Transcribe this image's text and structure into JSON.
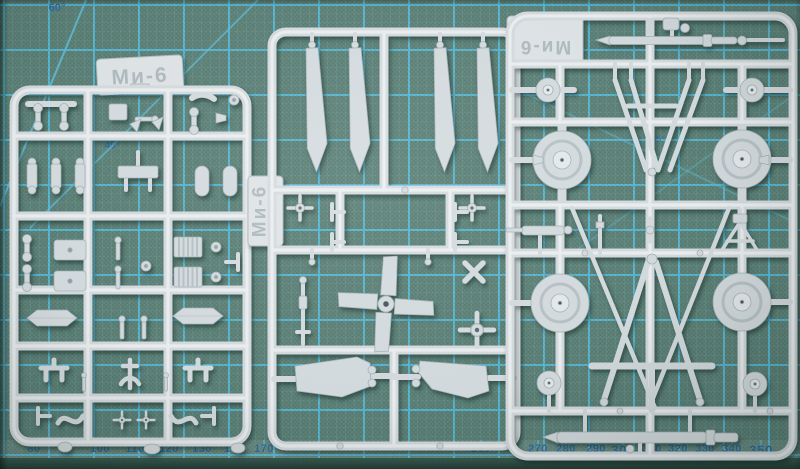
{
  "mat": {
    "angle_labels": [
      {
        "text": "60°",
        "x": 57,
        "y": 8,
        "size": 11,
        "opacity": 1
      },
      {
        "text": "45°",
        "x": 112,
        "y": 146,
        "size": 10,
        "opacity": 1
      },
      {
        "text": "45°",
        "x": 658,
        "y": 139,
        "size": 9,
        "opacity": 0.65
      }
    ],
    "ruler_labels": [
      {
        "text": "80",
        "x": 34,
        "large": false
      },
      {
        "text": "100",
        "x": 100,
        "large": false
      },
      {
        "text": "110",
        "x": 135,
        "large": false
      },
      {
        "text": "120",
        "x": 169,
        "large": false
      },
      {
        "text": "130",
        "x": 202,
        "large": false
      },
      {
        "text": "140",
        "x": 234,
        "large": false
      },
      {
        "text": "170",
        "x": 264,
        "large": false
      },
      {
        "text": "260",
        "x": 481,
        "large": false
      },
      {
        "text": "270",
        "x": 538,
        "large": false
      },
      {
        "text": "280",
        "x": 566,
        "large": false
      },
      {
        "text": "290",
        "x": 596,
        "large": false
      },
      {
        "text": "300",
        "x": 623,
        "large": true
      },
      {
        "text": "310",
        "x": 652,
        "large": false
      },
      {
        "text": "320",
        "x": 678,
        "large": false
      },
      {
        "text": "330",
        "x": 705,
        "large": false
      },
      {
        "text": "340",
        "x": 732,
        "large": false
      },
      {
        "text": "350",
        "x": 761,
        "large": true
      }
    ],
    "colors": {
      "mat_base": "#5d8278",
      "grid_major": "#54b6d3",
      "ruler_text": "#2e6d9c",
      "mat_edge": "#2d4c44"
    }
  },
  "sprues": {
    "plastic_color": "#d6dde0",
    "left": {
      "label": "Ми-6"
    },
    "middle": {
      "label": "Ми-6"
    },
    "right": {
      "label": "Ми-6"
    }
  }
}
